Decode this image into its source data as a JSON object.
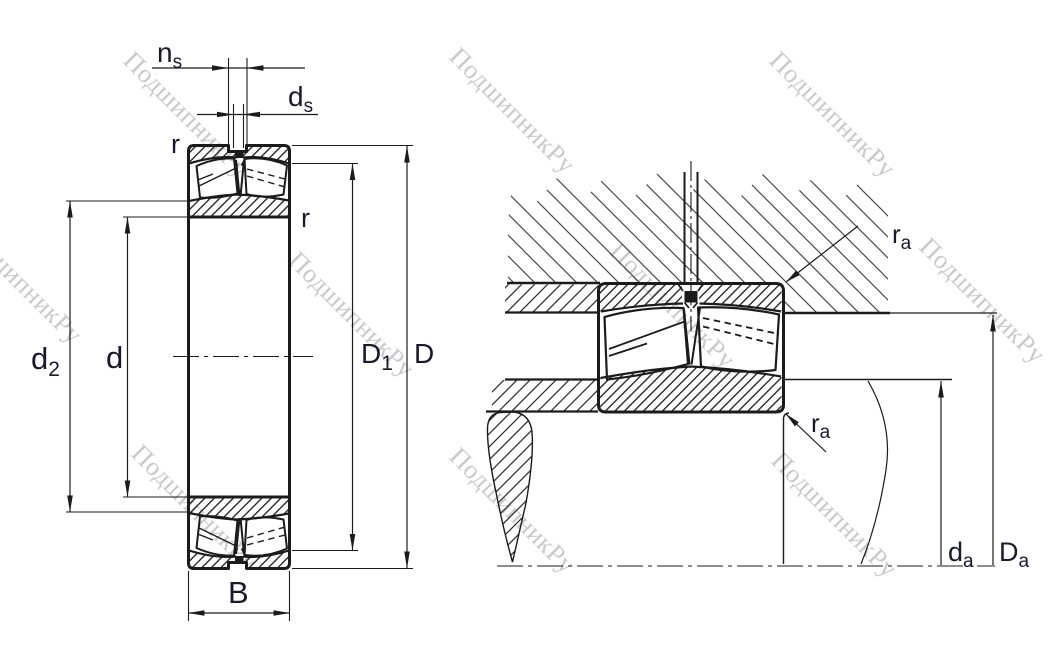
{
  "watermark": {
    "text": "ПодшипникРу",
    "color": "#c9c9c9"
  },
  "colors": {
    "line": "#1b1b1b",
    "ring_hatch": "#2a2a2a",
    "housing_hatch": "#474747",
    "label": "#18182e",
    "watermark": "#c9c9c9",
    "background": "#ffffff"
  },
  "labels": {
    "ns": {
      "base": "n",
      "sub": "s"
    },
    "ds": {
      "base": "d",
      "sub": "s"
    },
    "r_outer": {
      "base": "r",
      "sub": ""
    },
    "r_inner": {
      "base": "r",
      "sub": ""
    },
    "d2": {
      "base": "d",
      "sub": "2"
    },
    "d": {
      "base": "d",
      "sub": ""
    },
    "D1": {
      "base": "D",
      "sub": "1"
    },
    "D": {
      "base": "D",
      "sub": ""
    },
    "B": {
      "base": "B",
      "sub": ""
    },
    "ra_housing": {
      "base": "r",
      "sub": "a"
    },
    "ra_shaft": {
      "base": "r",
      "sub": "a"
    },
    "da": {
      "base": "d",
      "sub": "a"
    },
    "Da": {
      "base": "D",
      "sub": "a"
    }
  }
}
